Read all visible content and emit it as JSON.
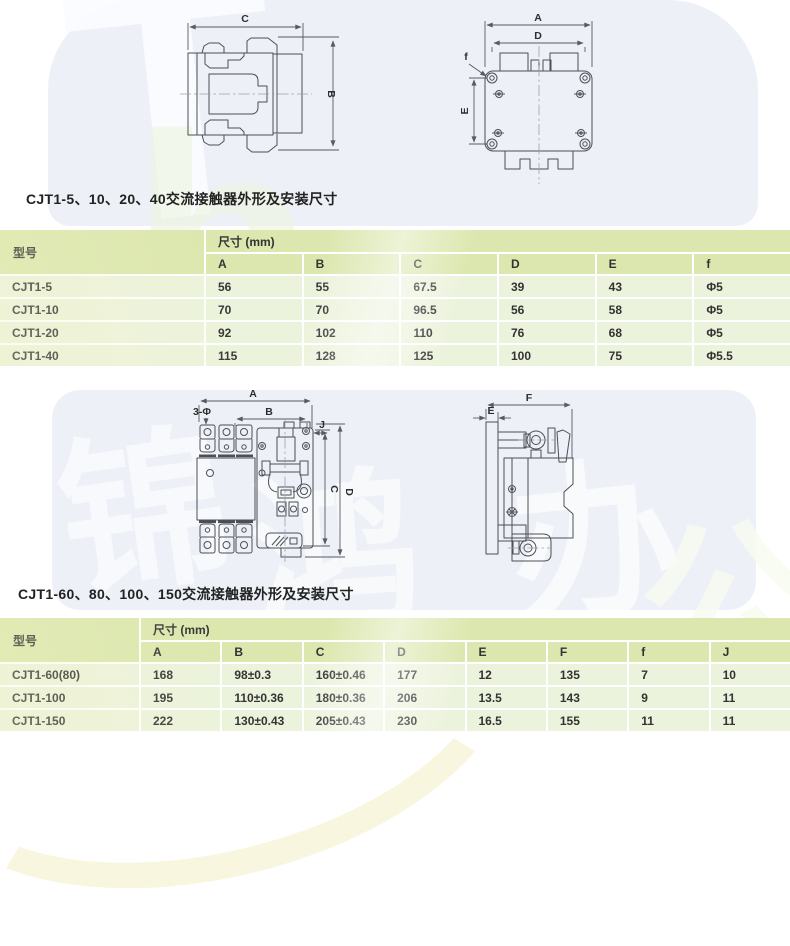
{
  "colors": {
    "header_green": "#dbe7ae",
    "row_green": "#ecf3dc",
    "band_blue": "#edf1f7",
    "line": "#4b5056"
  },
  "watermark": {
    "top_letter": "T",
    "mid_letter": "h",
    "char_1": "锦",
    "char_2": "鸿",
    "char_3": "办",
    "char_4": "公"
  },
  "drawings": {
    "view1": {
      "dim_top": "C",
      "dim_right": "B"
    },
    "view2": {
      "dim_overall_width": "A",
      "dim_mount_width": "D",
      "dim_mount_height": "E",
      "dim_hole": "f"
    },
    "view3": {
      "dim_overall_width": "A",
      "dim_mount_width": "B",
      "dim_offset": "J",
      "dim_holes": "3-Φ",
      "dim_height_inner": "C",
      "dim_height_outer": "D"
    },
    "view4": {
      "dim_depth": "F",
      "dim_plate": "E"
    }
  },
  "section1": {
    "title": "CJT1-5、10、20、40交流接触器外形及安装尺寸",
    "table": {
      "model_header": "型号",
      "size_header": "尺寸 (mm)",
      "columns": [
        "A",
        "B",
        "C",
        "D",
        "E",
        "f"
      ],
      "rows": [
        {
          "model": "CJT1-5",
          "values": [
            "56",
            "55",
            "67.5",
            "39",
            "43",
            "Φ5"
          ]
        },
        {
          "model": "CJT1-10",
          "values": [
            "70",
            "70",
            "96.5",
            "56",
            "58",
            "Φ5"
          ]
        },
        {
          "model": "CJT1-20",
          "values": [
            "92",
            "102",
            "110",
            "76",
            "68",
            "Φ5"
          ]
        },
        {
          "model": "CJT1-40",
          "values": [
            "115",
            "128",
            "125",
            "100",
            "75",
            "Φ5.5"
          ]
        }
      ]
    }
  },
  "section2": {
    "title": "CJT1-60、80、100、150交流接触器外形及安装尺寸",
    "table": {
      "model_header": "型号",
      "size_header": "尺寸 (mm)",
      "columns": [
        "A",
        "B",
        "C",
        "D",
        "E",
        "F",
        "f",
        "J"
      ],
      "rows": [
        {
          "model": "CJT1-60(80)",
          "values": [
            "168",
            "98±0.3",
            "160±0.46",
            "177",
            "12",
            "135",
            "7",
            "10"
          ]
        },
        {
          "model": "CJT1-100",
          "values": [
            "195",
            "110±0.36",
            "180±0.36",
            "206",
            "13.5",
            "143",
            "9",
            "11"
          ]
        },
        {
          "model": "CJT1-150",
          "values": [
            "222",
            "130±0.43",
            "205±0.43",
            "230",
            "16.5",
            "155",
            "11",
            "11"
          ]
        }
      ]
    }
  }
}
